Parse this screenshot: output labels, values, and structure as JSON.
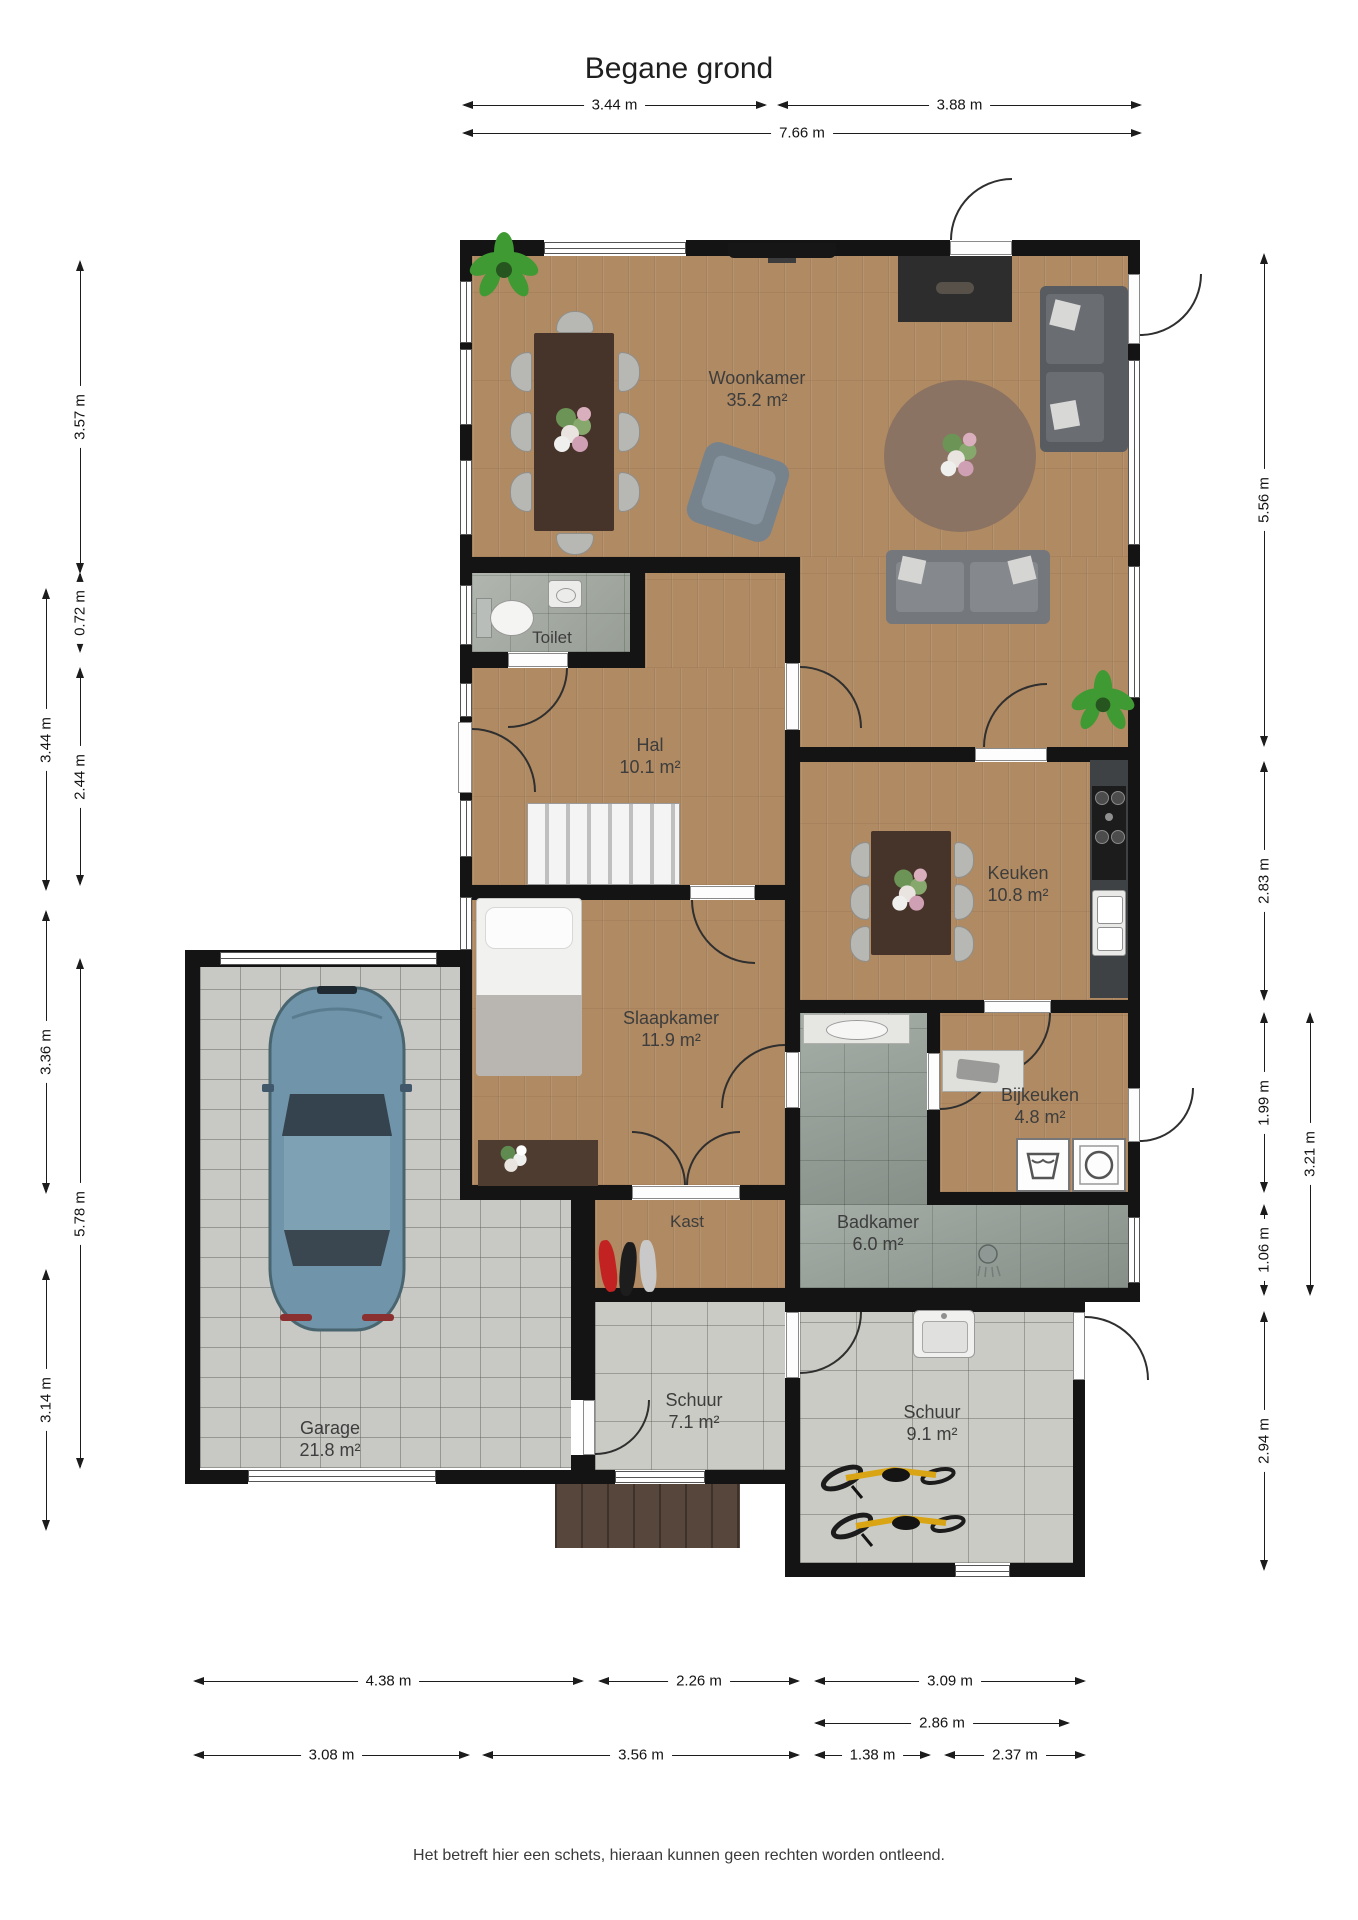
{
  "title": "Begane grond",
  "footer": "Het betreft hier een schets, hieraan kunnen geen rechten worden ontleend.",
  "rooms": {
    "woonkamer": {
      "name": "Woonkamer",
      "area": "35.2 m²"
    },
    "toilet": {
      "name": "Toilet"
    },
    "hal": {
      "name": "Hal",
      "area": "10.1 m²"
    },
    "keuken": {
      "name": "Keuken",
      "area": "10.8 m²"
    },
    "slaapkamer": {
      "name": "Slaapkamer",
      "area": "11.9 m²"
    },
    "bijkeuken": {
      "name": "Bijkeuken",
      "area": "4.8 m²"
    },
    "badkamer": {
      "name": "Badkamer",
      "area": "6.0 m²"
    },
    "kast": {
      "name": "Kast"
    },
    "garage": {
      "name": "Garage",
      "area": "21.8 m²"
    },
    "schuur_klein": {
      "name": "Schuur",
      "area": "7.1 m²"
    },
    "schuur_groot": {
      "name": "Schuur",
      "area": "9.1 m²"
    }
  },
  "dimensions": {
    "top": [
      "3.44 m",
      "3.88 m",
      "7.66 m"
    ],
    "left_outer": [
      "3.44 m",
      "3.36 m",
      "3.14 m"
    ],
    "left_inner": [
      "3.57 m",
      "0.72 m",
      "2.44 m",
      "5.78 m"
    ],
    "right_inner": [
      "5.56 m",
      "2.83 m",
      "1.99 m",
      "1.06 m",
      "2.94 m"
    ],
    "right_outer": [
      "3.21 m"
    ],
    "bottom_row1": [
      "4.38 m",
      "2.26 m",
      "3.09 m"
    ],
    "bottom_row2": [
      "2.86 m"
    ],
    "bottom_row3": [
      "3.08 m",
      "3.56 m",
      "1.38 m",
      "2.37 m"
    ]
  },
  "colors": {
    "wall": "#141414",
    "wood_floor": "#b08a62",
    "tile_floor": "#a4aba2",
    "pavement": "#c8c8c4",
    "car_body": "#7094aa",
    "bike_frame": "#d9a514"
  }
}
